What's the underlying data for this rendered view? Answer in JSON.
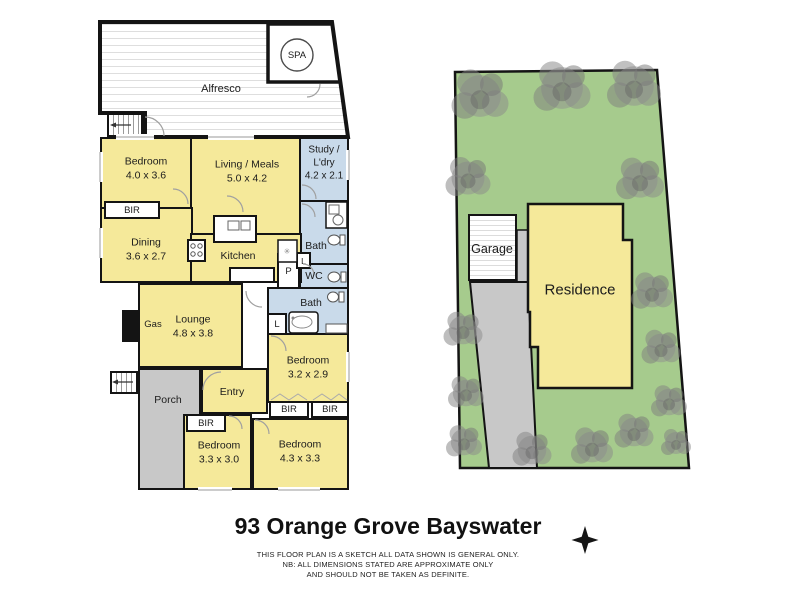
{
  "title": "93 Orange Grove Bayswater",
  "disclaimer": [
    "THIS FLOOR PLAN IS A SKETCH ALL DATA SHOWN IS GENERAL ONLY.",
    "NB: ALL DIMENSIONS STATED ARE APPROXIMATE ONLY",
    "AND SHOULD NOT BE TAKEN AS DEFINITE."
  ],
  "colors": {
    "room_yellow": "#F5E99A",
    "wet_area_blue": "#C9DAEA",
    "lot_green": "#A6CB8D",
    "paving_gray": "#C8C8C8",
    "wall_black": "#141414"
  },
  "floor_plan": {
    "alfresco": {
      "label": "Alfresco"
    },
    "spa": {
      "label": "SPA"
    },
    "bedroom1": {
      "label": "Bedroom",
      "dims": "4.0 x 3.6"
    },
    "living": {
      "label": "Living / Meals",
      "dims": "5.0 x 4.2"
    },
    "study": {
      "label": "Study / L'dry",
      "dims": "4.2 x 2.1"
    },
    "dining": {
      "label": "Dining",
      "dims": "3.6 x 2.7"
    },
    "kitchen": {
      "label": "Kitchen"
    },
    "lounge": {
      "label": "Lounge",
      "dims": "4.8 x 3.8"
    },
    "gas": {
      "label": "Gas"
    },
    "porch": {
      "label": "Porch"
    },
    "entry": {
      "label": "Entry"
    },
    "bath1": {
      "label": "Bath"
    },
    "wc": {
      "label": "WC"
    },
    "bath2": {
      "label": "Bath"
    },
    "bedroom2": {
      "label": "Bedroom",
      "dims": "3.2 x 2.9"
    },
    "bedroom3": {
      "label": "Bedroom",
      "dims": "3.3 x 3.0"
    },
    "bedroom4": {
      "label": "Bedroom",
      "dims": "4.3 x 3.3"
    },
    "bir1": {
      "label": "BIR"
    },
    "bir2": {
      "label": "BIR"
    },
    "bir3": {
      "label": "BIR"
    },
    "bir4": {
      "label": "BIR"
    },
    "pantry": {
      "label": "P"
    },
    "linen1": {
      "label": "L"
    },
    "linen2": {
      "label": "L"
    }
  },
  "site_plan": {
    "garage": {
      "label": "Garage"
    },
    "residence": {
      "label": "Residence"
    }
  }
}
